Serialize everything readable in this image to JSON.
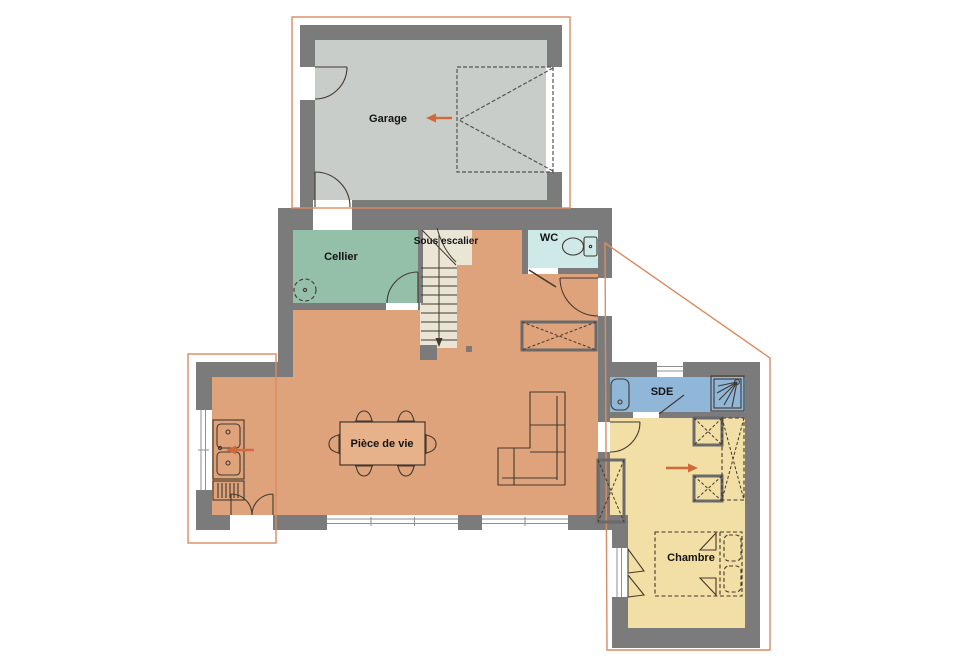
{
  "plan": {
    "type": "floor-plan",
    "rooms": {
      "garage": {
        "label": "Garage",
        "floor_color": "#c9cdc9"
      },
      "cellier": {
        "label": "Cellier",
        "floor_color": "#94bfa9"
      },
      "sous_escalier": {
        "label": "Sous escalier",
        "floor_color": "#ebe5d5"
      },
      "wc": {
        "label": "WC",
        "floor_color": "#cfe9e9"
      },
      "piece_de_vie": {
        "label": "Pièce de vie",
        "floor_color": "#dfa37c"
      },
      "sde": {
        "label": "SDE",
        "floor_color": "#90b6d8"
      },
      "chambre": {
        "label": "Chambre",
        "floor_color": "#f2dfa5"
      }
    },
    "colors": {
      "wall": "#7b7b7b",
      "roof_outline": "#dc8c60",
      "arrow": "#d2693a",
      "fixture_line": "#43382e",
      "background": "#ffffff",
      "table_fill": "#e7b189"
    },
    "arrows": [
      {
        "name": "garage-arrow",
        "direction": "left"
      },
      {
        "name": "kitchen-arrow",
        "direction": "left"
      },
      {
        "name": "chambre-arrow",
        "direction": "right"
      }
    ],
    "stairs": {
      "direction": "down"
    }
  }
}
